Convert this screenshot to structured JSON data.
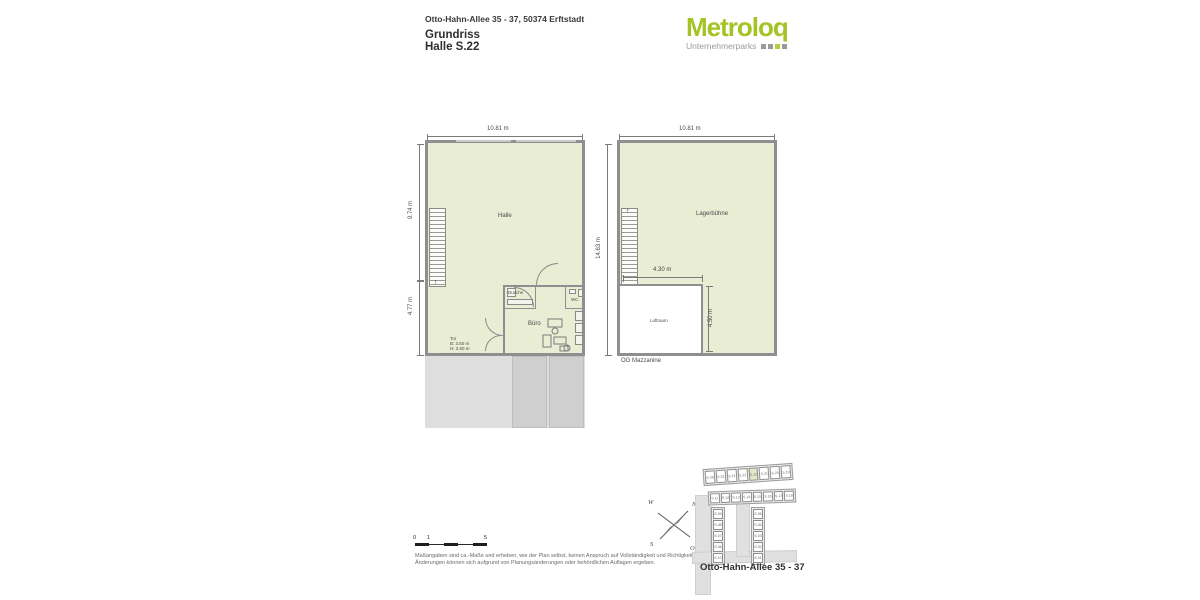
{
  "header": {
    "address": "Otto-Hahn-Allee 35 - 37, 50374 Erftstadt",
    "title": "Grundriss",
    "subtitle": "Halle S.22"
  },
  "logo": {
    "brand": "Metroloq",
    "tagline": "Unternehmerparks",
    "brand_color": "#a6c325",
    "tagline_color": "#9a9a9a",
    "squares": [
      "#9a9a9a",
      "#9a9a9a",
      "#b5cf3a",
      "#9a9a9a"
    ]
  },
  "ground_plan": {
    "dim_width": "10.81 m",
    "dim_height_upper": "9.74 m",
    "dim_height_lower": "4.77 m",
    "hall_label": "Halle",
    "shower_label": "Dusche",
    "wc_label": "WC",
    "office_label": "Büro",
    "gate_line1": "Tor",
    "gate_line2": "B: 3.50 m",
    "gate_line3": "H: 3.50 m"
  },
  "mezzanine_plan": {
    "dim_width": "10.81 m",
    "dim_height": "14.63 m",
    "void_width": "4.30 m",
    "void_height": "4.50 m",
    "storage_label": "Lagerbühne",
    "void_label": "Luftraum",
    "caption": "OG Mazzanine"
  },
  "scalebar": {
    "start": "0",
    "mid": "1",
    "end": "5"
  },
  "disclaimer": {
    "line1": "Maßangaben sind ca.-Maße und erheben, wie der Plan selbst, keinen Anspruch auf Vollständigkeit und Richtigkeit.",
    "line2": "Änderungen können sich aufgrund von Planungsänderungen oder behördlichen Auflagen ergeben."
  },
  "sitemap": {
    "caption": "Otto-Hahn-Allee 35 - 37",
    "highlight_unit": "S.22",
    "compass": {
      "nw": "W",
      "ne": "N",
      "sw": "S",
      "se": "O"
    },
    "top_row": [
      "S.26",
      "S.25",
      "S.24",
      "S.23",
      "S.22",
      "S.21",
      "S.20",
      "S.19"
    ],
    "mid_row": [
      "S.11",
      "S.12",
      "S.13",
      "S.14",
      "S.15",
      "S.16",
      "S.17",
      "S.18"
    ],
    "left_col": [
      "S.09",
      "S.08",
      "S.07",
      "S.06",
      "S.10"
    ],
    "right_col": [
      "S.05",
      "S.04",
      "S.03",
      "S.02",
      "S.01"
    ]
  },
  "colors": {
    "plan_fill": "#e9edd4",
    "wall": "#8f8f8f",
    "apron": "#dedede",
    "apron_dark": "#cfcfcf",
    "highlight": "#e3e9c8",
    "brand_green": "#a6c325"
  }
}
